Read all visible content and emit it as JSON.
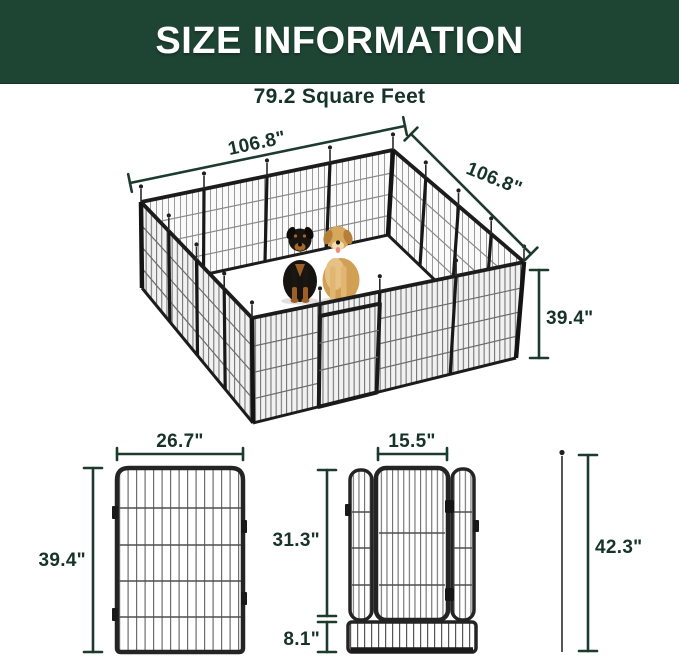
{
  "header": {
    "title": "SIZE INFORMATION"
  },
  "area": {
    "label": "79.2 Square Feet"
  },
  "pen": {
    "top_width": "106.8\"",
    "side_depth": "106.8\"",
    "wall_height": "39.4\""
  },
  "panel_diagram": {
    "width": "26.7\"",
    "height": "39.4\""
  },
  "door_diagram": {
    "door_width": "15.5\"",
    "upper_height": "31.3\"",
    "base_height": "8.1\""
  },
  "stake_diagram": {
    "total_height": "42.3\""
  },
  "colors": {
    "banner_green": "#1e4434",
    "dimension_green": "#16332a",
    "metal_dark": "#1f1f1f"
  }
}
